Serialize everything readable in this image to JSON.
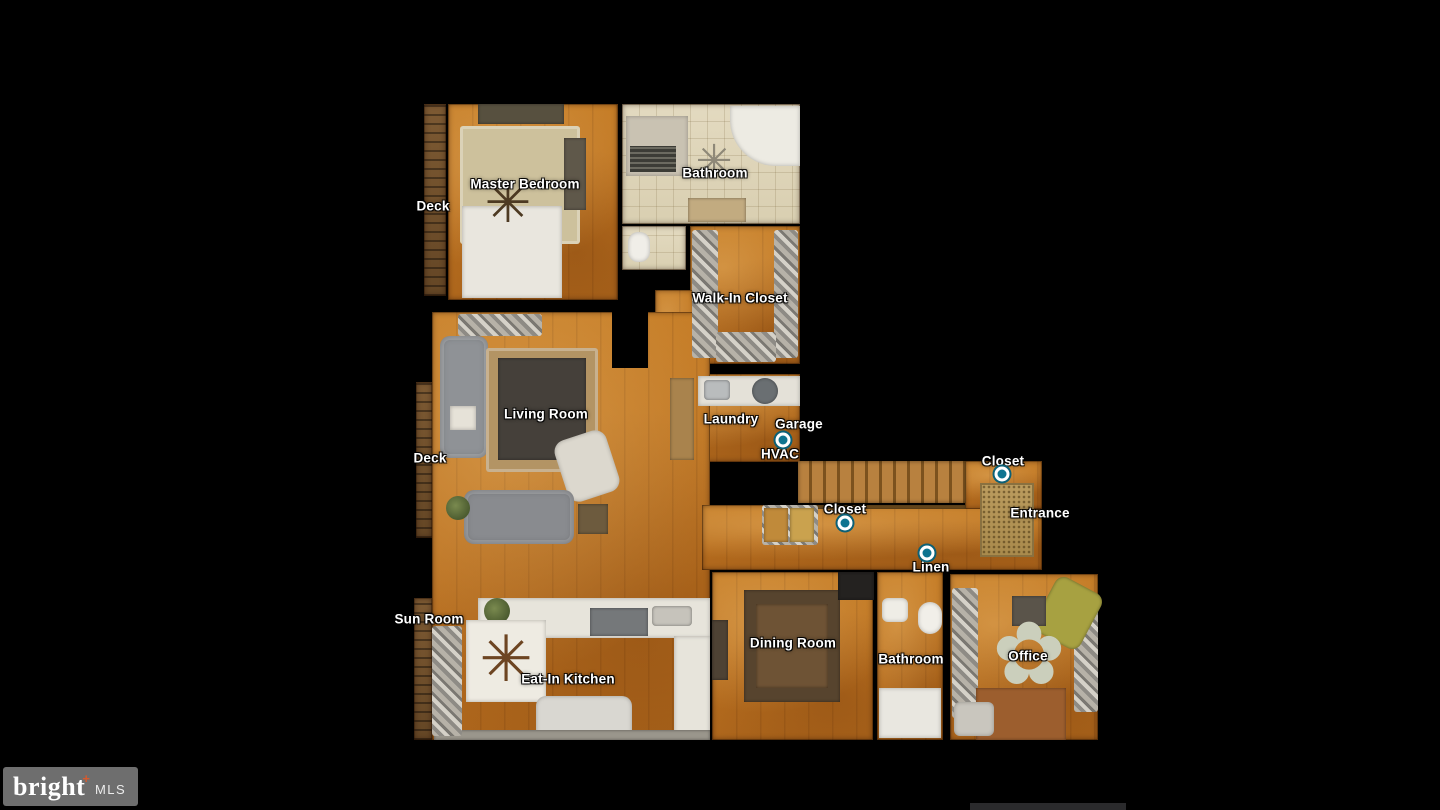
{
  "canvas": {
    "width": 1440,
    "height": 810,
    "background": "#000000"
  },
  "palette": {
    "wood_floor": "#bd7322",
    "tile_floor": "#e0d7bd",
    "deck_wood": "#6b4c2a",
    "label_text": "#ffffff",
    "marker_fill": "#0e7490",
    "marker_ring": "#ffffff",
    "marker_outline": "#0c6076",
    "logo_bg": "#6e6e6e",
    "logo_accent": "#d65a2e",
    "bottom_bar": "#2a2a2c"
  },
  "logo": {
    "brand": "bright",
    "plus": "+",
    "suffix": "MLS"
  },
  "floorplan": {
    "rooms": [
      {
        "name": "deck-top",
        "material": "deck",
        "x": 424,
        "y": 104,
        "w": 22,
        "h": 192
      },
      {
        "name": "master-bedroom",
        "material": "wood",
        "x": 448,
        "y": 104,
        "w": 170,
        "h": 196
      },
      {
        "name": "bathroom-top",
        "material": "tile",
        "x": 622,
        "y": 104,
        "w": 178,
        "h": 120
      },
      {
        "name": "toilet-room",
        "material": "tile",
        "x": 622,
        "y": 226,
        "w": 64,
        "h": 44
      },
      {
        "name": "walk-in-closet",
        "material": "wood",
        "x": 690,
        "y": 226,
        "w": 110,
        "h": 138
      },
      {
        "name": "corridor",
        "material": "wood",
        "x": 655,
        "y": 290,
        "w": 40,
        "h": 84
      },
      {
        "name": "laundry",
        "material": "wood",
        "x": 668,
        "y": 374,
        "w": 132,
        "h": 88
      },
      {
        "name": "living-kitchen-area",
        "material": "wood",
        "x": 432,
        "y": 312,
        "w": 278,
        "h": 428
      },
      {
        "name": "deck-mid",
        "material": "deck",
        "x": 416,
        "y": 382,
        "w": 16,
        "h": 156
      },
      {
        "name": "sun-room-strip",
        "material": "deck",
        "x": 414,
        "y": 598,
        "w": 18,
        "h": 142
      },
      {
        "name": "hall-lower",
        "material": "wood",
        "x": 702,
        "y": 505,
        "w": 340,
        "h": 65
      },
      {
        "name": "hall-entrance-upper",
        "material": "wood",
        "x": 965,
        "y": 461,
        "w": 77,
        "h": 48
      },
      {
        "name": "dining-room",
        "material": "wood",
        "x": 712,
        "y": 572,
        "w": 161,
        "h": 168
      },
      {
        "name": "bathroom-bottom",
        "material": "wood",
        "x": 877,
        "y": 572,
        "w": 66,
        "h": 168
      },
      {
        "name": "office",
        "material": "wood",
        "x": 950,
        "y": 574,
        "w": 148,
        "h": 166
      }
    ],
    "furniture": [
      {
        "name": "wall-stub-living",
        "kind": "wallpatch",
        "x": 612,
        "y": 312,
        "w": 36,
        "h": 56,
        "color": "#000000"
      },
      {
        "name": "furn-mb-dresser",
        "kind": "dark",
        "x": 478,
        "y": 104,
        "w": 86,
        "h": 20,
        "color": "#57503f"
      },
      {
        "name": "furn-mb-rug",
        "kind": "rug",
        "x": 460,
        "y": 126,
        "w": 120,
        "h": 118,
        "color": "#cdc19c"
      },
      {
        "name": "furn-mb-cabinet",
        "kind": "dark",
        "x": 564,
        "y": 138,
        "w": 22,
        "h": 72,
        "color": "#5f584a"
      },
      {
        "name": "furn-mb-bed",
        "kind": "white",
        "x": 462,
        "y": 206,
        "w": 100,
        "h": 92,
        "color": "#e9e6de"
      },
      {
        "name": "furn-mb-ceiling-fan",
        "kind": "glyph",
        "glyph": "✳",
        "x": 480,
        "y": 176,
        "w": 56,
        "h": 56,
        "color": "#4d3a22"
      },
      {
        "name": "furn-bath-tub",
        "kind": "white",
        "x": 730,
        "y": 106,
        "w": 70,
        "h": 60,
        "color": "#edebe3",
        "radius": "0 0 0 46px"
      },
      {
        "name": "furn-bath-shower",
        "kind": "white",
        "x": 626,
        "y": 116,
        "w": 62,
        "h": 60,
        "color": "#c9c2b2"
      },
      {
        "name": "furn-bath-grate",
        "kind": "grate",
        "x": 630,
        "y": 146,
        "w": 46,
        "h": 26
      },
      {
        "name": "furn-bath-ceiling-fan",
        "kind": "glyph",
        "glyph": "✳",
        "x": 692,
        "y": 140,
        "w": 44,
        "h": 44,
        "color": "#8e8878"
      },
      {
        "name": "furn-bath-vanity",
        "kind": "dark",
        "x": 688,
        "y": 198,
        "w": 58,
        "h": 24,
        "color": "#c2ab80"
      },
      {
        "name": "furn-wc-toilet",
        "kind": "white",
        "x": 628,
        "y": 232,
        "w": 22,
        "h": 30,
        "color": "#f0eee8",
        "radius": "10px"
      },
      {
        "name": "furn-wic-clothes-left",
        "kind": "clutter",
        "x": 692,
        "y": 230,
        "w": 26,
        "h": 128
      },
      {
        "name": "furn-wic-clothes-right",
        "kind": "clutter",
        "x": 774,
        "y": 230,
        "w": 24,
        "h": 128
      },
      {
        "name": "furn-wic-clothes-bottom",
        "kind": "clutter",
        "x": 716,
        "y": 332,
        "w": 60,
        "h": 30
      },
      {
        "name": "furn-ld-door",
        "kind": "dark",
        "x": 670,
        "y": 378,
        "w": 24,
        "h": 82,
        "color": "#a9834d"
      },
      {
        "name": "furn-ld-counter",
        "kind": "white",
        "x": 698,
        "y": 376,
        "w": 102,
        "h": 30,
        "color": "#e4e1d8"
      },
      {
        "name": "furn-ld-sink",
        "kind": "dark",
        "x": 704,
        "y": 380,
        "w": 26,
        "h": 20,
        "color": "#b9bcbd",
        "radius": "4px"
      },
      {
        "name": "furn-ld-washer",
        "kind": "dark",
        "x": 752,
        "y": 378,
        "w": 26,
        "h": 26,
        "color": "#6a6f72",
        "radius": "50%"
      },
      {
        "name": "furn-lr-shelf",
        "kind": "clutter",
        "x": 458,
        "y": 314,
        "w": 84,
        "h": 22
      },
      {
        "name": "furn-lr-sofa-left",
        "kind": "sofa",
        "x": 440,
        "y": 336,
        "w": 48,
        "h": 122,
        "color": "#8f9296",
        "radius": "10px"
      },
      {
        "name": "furn-lr-console",
        "kind": "white",
        "x": 450,
        "y": 406,
        "w": 26,
        "h": 24,
        "color": "#e6e2d8"
      },
      {
        "name": "furn-lr-rug",
        "kind": "rug",
        "x": 486,
        "y": 348,
        "w": 112,
        "h": 124,
        "color": "#b39464"
      },
      {
        "name": "furn-lr-coffee-table",
        "kind": "dark",
        "x": 498,
        "y": 358,
        "w": 88,
        "h": 102,
        "color": "#45403a"
      },
      {
        "name": "furn-lr-armchair",
        "kind": "white",
        "x": 560,
        "y": 434,
        "w": 54,
        "h": 64,
        "color": "#dcd8ce",
        "radius": "12px",
        "rot": -18
      },
      {
        "name": "furn-lr-sofa-bottom",
        "kind": "sofa",
        "x": 464,
        "y": 490,
        "w": 110,
        "h": 54,
        "color": "#898b8f",
        "radius": "10px"
      },
      {
        "name": "furn-lr-plant",
        "kind": "plant",
        "x": 446,
        "y": 496,
        "w": 24,
        "h": 24
      },
      {
        "name": "furn-lr-side-table",
        "kind": "dark",
        "x": 578,
        "y": 504,
        "w": 30,
        "h": 30,
        "color": "#6d5b3e"
      },
      {
        "name": "furn-kt-counter-top",
        "kind": "white",
        "x": 478,
        "y": 598,
        "w": 232,
        "h": 40,
        "color": "#e7e4db"
      },
      {
        "name": "furn-kt-plant",
        "kind": "plant",
        "x": 484,
        "y": 598,
        "w": 26,
        "h": 26
      },
      {
        "name": "furn-kt-stove",
        "kind": "dark",
        "x": 590,
        "y": 608,
        "w": 58,
        "h": 28,
        "color": "#75787a"
      },
      {
        "name": "furn-kt-sink-top",
        "kind": "dark",
        "x": 652,
        "y": 606,
        "w": 40,
        "h": 20,
        "color": "#c6c3bb",
        "radius": "4px"
      },
      {
        "name": "furn-kt-counter-right",
        "kind": "white",
        "x": 674,
        "y": 636,
        "w": 36,
        "h": 100,
        "color": "#e7e4db"
      },
      {
        "name": "furn-kt-table",
        "kind": "white",
        "x": 466,
        "y": 620,
        "w": 80,
        "h": 82,
        "color": "#eeebe2"
      },
      {
        "name": "furn-kt-ceiling-fan",
        "kind": "glyph",
        "glyph": "✳",
        "x": 474,
        "y": 628,
        "w": 64,
        "h": 64,
        "color": "#6d4522"
      },
      {
        "name": "furn-kt-range-bottom",
        "kind": "white",
        "x": 536,
        "y": 696,
        "w": 96,
        "h": 44,
        "color": "#d9d7d1",
        "radius": "10px 10px 0 0"
      },
      {
        "name": "furn-kt-ledge",
        "kind": "dark",
        "x": 434,
        "y": 730,
        "w": 276,
        "h": 10,
        "color": "#9a968c"
      },
      {
        "name": "furn-sr-items",
        "kind": "clutter",
        "x": 432,
        "y": 626,
        "w": 30,
        "h": 110
      },
      {
        "name": "furn-hall-stairs",
        "kind": "stairs",
        "x": 798,
        "y": 461,
        "w": 168,
        "h": 42
      },
      {
        "name": "furn-hall-rail",
        "kind": "dark",
        "x": 798,
        "y": 505,
        "w": 168,
        "h": 4,
        "color": "#6e4c1e"
      },
      {
        "name": "furn-hall-mat",
        "kind": "mat",
        "x": 980,
        "y": 483,
        "w": 54,
        "h": 74
      },
      {
        "name": "furn-hall-closet-shelf",
        "kind": "clutter",
        "x": 762,
        "y": 505,
        "w": 56,
        "h": 40
      },
      {
        "name": "furn-hall-closet-item-a",
        "kind": "dark",
        "x": 764,
        "y": 508,
        "w": 24,
        "h": 34,
        "color": "#c08a3a"
      },
      {
        "name": "furn-hall-closet-item-b",
        "kind": "dark",
        "x": 790,
        "y": 508,
        "w": 24,
        "h": 34,
        "color": "#caa24e"
      },
      {
        "name": "furn-dr-table",
        "kind": "dark",
        "x": 744,
        "y": 590,
        "w": 96,
        "h": 112,
        "color": "#57442e"
      },
      {
        "name": "furn-dr-table-top",
        "kind": "dark",
        "x": 756,
        "y": 604,
        "w": 72,
        "h": 84,
        "color": "#6e5335"
      },
      {
        "name": "furn-dr-chair-dark",
        "kind": "dark",
        "x": 838,
        "y": 572,
        "w": 36,
        "h": 28,
        "color": "#242220"
      },
      {
        "name": "furn-dr-buffet",
        "kind": "dark",
        "x": 712,
        "y": 620,
        "w": 16,
        "h": 60,
        "color": "#4e4234"
      },
      {
        "name": "furn-b2-sink",
        "kind": "white",
        "x": 882,
        "y": 598,
        "w": 26,
        "h": 24,
        "color": "#efede6",
        "radius": "6px"
      },
      {
        "name": "furn-b2-toilet",
        "kind": "white",
        "x": 918,
        "y": 602,
        "w": 24,
        "h": 32,
        "color": "#f1efe9",
        "radius": "12px"
      },
      {
        "name": "furn-b2-tub",
        "kind": "white",
        "x": 879,
        "y": 688,
        "w": 62,
        "h": 50,
        "color": "#e9e7e0"
      },
      {
        "name": "furn-of-clutter-left",
        "kind": "clutter",
        "x": 952,
        "y": 588,
        "w": 26,
        "h": 130
      },
      {
        "name": "furn-of-clutter-right",
        "kind": "clutter",
        "x": 1074,
        "y": 596,
        "w": 24,
        "h": 116
      },
      {
        "name": "furn-of-chair-green",
        "kind": "dark",
        "x": 1042,
        "y": 582,
        "w": 52,
        "h": 62,
        "color": "#a7a141",
        "radius": "10px",
        "rot": 28
      },
      {
        "name": "furn-of-item-top",
        "kind": "dark",
        "x": 1012,
        "y": 596,
        "w": 34,
        "h": 30,
        "color": "#5a544a"
      },
      {
        "name": "furn-of-flower-rug",
        "kind": "glyph",
        "glyph": "✿",
        "x": 985,
        "y": 610,
        "w": 88,
        "h": 88,
        "color": "#cbcfbc"
      },
      {
        "name": "furn-of-desk",
        "kind": "dark",
        "x": 976,
        "y": 688,
        "w": 90,
        "h": 52,
        "color": "#9c5e2e"
      },
      {
        "name": "furn-of-tv",
        "kind": "white",
        "x": 954,
        "y": 702,
        "w": 40,
        "h": 34,
        "color": "#c9c6be",
        "radius": "6px"
      }
    ],
    "labels": [
      {
        "name": "label-master-bedroom",
        "text": "Master Bedroom",
        "x": 525,
        "y": 184
      },
      {
        "name": "label-bathroom-top",
        "text": "Bathroom",
        "x": 715,
        "y": 173
      },
      {
        "name": "label-deck-top",
        "text": "Deck",
        "x": 433,
        "y": 206
      },
      {
        "name": "label-walk-in-closet",
        "text": "Walk-In Closet",
        "x": 740,
        "y": 298
      },
      {
        "name": "label-laundry",
        "text": "Laundry",
        "x": 731,
        "y": 419
      },
      {
        "name": "label-garage",
        "text": "Garage",
        "x": 799,
        "y": 424
      },
      {
        "name": "label-hvac",
        "text": "HVAC",
        "x": 780,
        "y": 454
      },
      {
        "name": "label-living-room",
        "text": "Living Room",
        "x": 546,
        "y": 414
      },
      {
        "name": "label-deck-mid",
        "text": "Deck",
        "x": 430,
        "y": 458
      },
      {
        "name": "label-closet-hall",
        "text": "Closet",
        "x": 845,
        "y": 509
      },
      {
        "name": "label-closet-entrance",
        "text": "Closet",
        "x": 1003,
        "y": 461
      },
      {
        "name": "label-entrance",
        "text": "Entrance",
        "x": 1040,
        "y": 513
      },
      {
        "name": "label-linen",
        "text": "Linen",
        "x": 931,
        "y": 567
      },
      {
        "name": "label-sun-room",
        "text": "Sun Room",
        "x": 429,
        "y": 619
      },
      {
        "name": "label-eat-in-kitchen",
        "text": "Eat-In Kitchen",
        "x": 568,
        "y": 679
      },
      {
        "name": "label-dining-room",
        "text": "Dining Room",
        "x": 793,
        "y": 643
      },
      {
        "name": "label-bathroom-bottom",
        "text": "Bathroom",
        "x": 911,
        "y": 659
      },
      {
        "name": "label-office",
        "text": "Office",
        "x": 1028,
        "y": 656
      }
    ],
    "markers": [
      {
        "name": "marker-garage-hvac",
        "x": 783,
        "y": 440
      },
      {
        "name": "marker-closet-hall",
        "x": 845,
        "y": 523
      },
      {
        "name": "marker-closet-entrance",
        "x": 1002,
        "y": 474
      },
      {
        "name": "marker-linen",
        "x": 927,
        "y": 553
      }
    ]
  }
}
